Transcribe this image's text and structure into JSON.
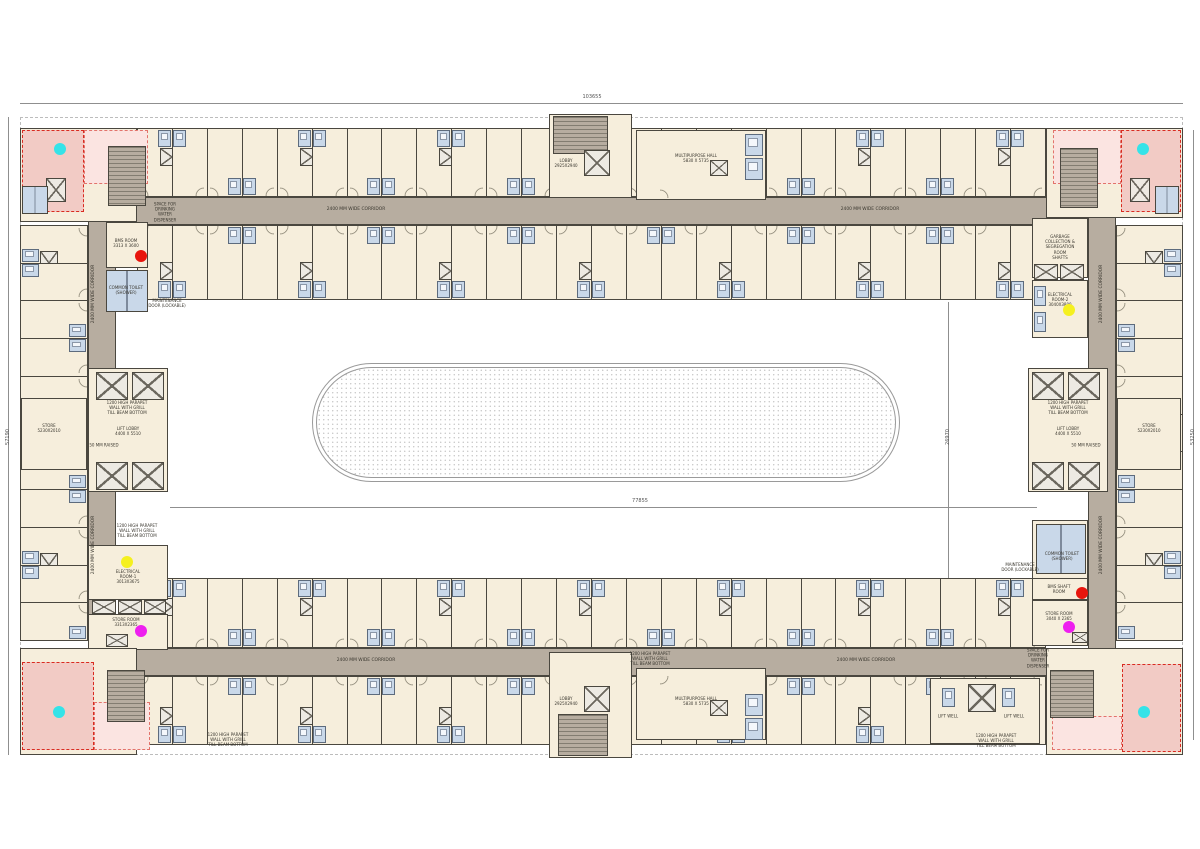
{
  "drawing_type": "residential-block-floor-plan",
  "dimensions": {
    "overall_width": "103655",
    "left_height": "57190",
    "right_height": "53250",
    "courtyard_width": "77855",
    "courtyard_height": "26970"
  },
  "labels": {
    "corridor": "2400 MM WIDE CORRIDOR",
    "parapet": "1200 HIGH PARAPET\nWALL WITH GRILL\nTILL BEAM BOTTOM",
    "multipurpose_hall": "MULTIPURPOSE HALL\n5830 X 5735",
    "lobby": "LOBBY\n2925X2940",
    "lift_lobby": "LIFT LOBBY\n4400 X 5510",
    "raised": "50 MM RAISED",
    "store": "STORE\n5230X2010",
    "water_dispenser": "SPACE FOR\nDRINKING\nWATER\nDISPENSER",
    "maintenance_door": "MAINTENANCE\nDOOR (LOCKABLE)",
    "bms_room": "BMS ROOM\n3313 X 3600",
    "bms_shaft_room": "BMS SHAFT\nROOM",
    "common_toilet": "COMMON TOILET\n(SHOWER)",
    "garbage": "GARBAGE\nCOLLECTION &\nSEGREGATION\nROOM\nSHAFTS",
    "electrical_room_1": "ELECTRICAL\nROOM-1\n3013X3675",
    "electrical_room_2": "ELECTRICAL\nROOM-2\n3040X3800",
    "store_room_left": "STORE ROOM\n3313X2365",
    "store_room_right": "STORE ROOM\n3040 X 2365",
    "lift_well": "LIFT WELL"
  },
  "palette": {
    "room": "#F6EEDC",
    "bath": "#C9D8E9",
    "corridor": "#B7ADA0",
    "wall": "#4A473F",
    "refuge_strong": "#F2CBC5",
    "refuge_light": "#FBE4E1",
    "refuge_border": "#D92B20"
  },
  "marker_colors": {
    "dot_cyan": "#35E3E8",
    "dot_red": "#E8150D",
    "dot_yellow": "#F5F01F",
    "dot_magenta": "#EE1FEF"
  }
}
